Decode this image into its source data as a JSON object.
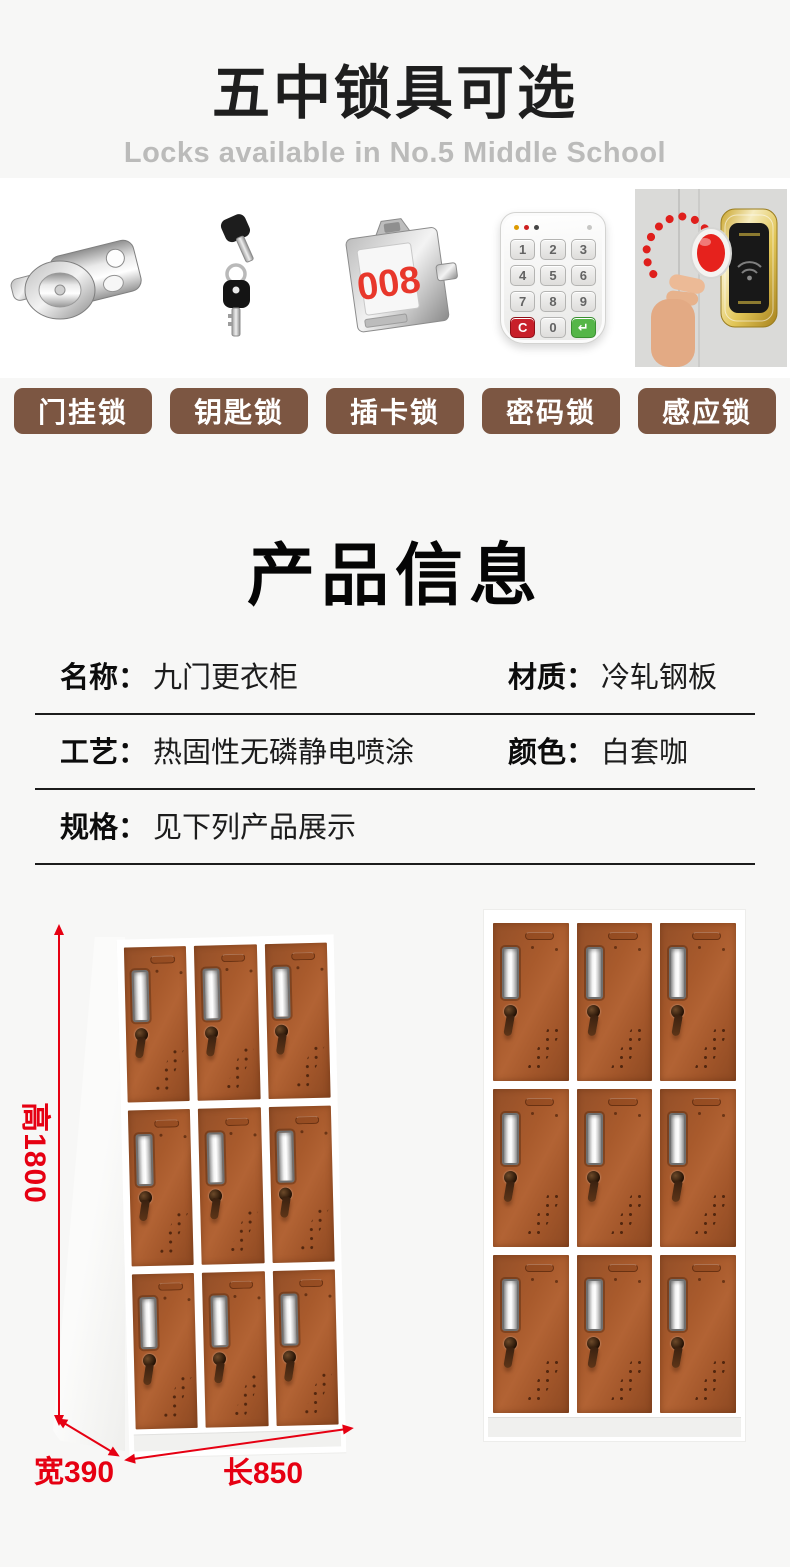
{
  "header": {
    "title": "五中锁具可选",
    "subtitle": "Locks available in No.5 Middle School"
  },
  "lock_types": {
    "button_bg": "#7c5642",
    "items": [
      {
        "label": "门挂锁",
        "icon": "hasp-lock"
      },
      {
        "label": "钥匙锁",
        "icon": "key-lock"
      },
      {
        "label": "插卡锁",
        "icon": "card-lock",
        "number": "008"
      },
      {
        "label": "密码锁",
        "icon": "keypad-lock",
        "keys": [
          "1",
          "2",
          "3",
          "4",
          "5",
          "6",
          "7",
          "8",
          "9",
          "C",
          "0",
          "↵"
        ]
      },
      {
        "label": "感应锁",
        "icon": "rfid-lock"
      }
    ]
  },
  "product_info": {
    "title": "产品信息",
    "rows": [
      {
        "cells": [
          {
            "label": "名称：",
            "value": "九门更衣柜"
          },
          {
            "label": "材质：",
            "value": "冷轧钢板"
          }
        ]
      },
      {
        "cells": [
          {
            "label": "工艺：",
            "value": "热固性无磷静电喷涂"
          },
          {
            "label": "颜色：",
            "value": "白套咖"
          }
        ]
      },
      {
        "cells": [
          {
            "label": "规格：",
            "value": "见下列产品展示"
          }
        ]
      }
    ]
  },
  "showcase": {
    "dimensions": {
      "height": "高1800",
      "width": "宽390",
      "length": "长850",
      "accent_color": "#e60012"
    },
    "locker": {
      "rows": 3,
      "cols": 3,
      "door_color": "#a85a2c",
      "frame_color": "#ffffff"
    }
  }
}
